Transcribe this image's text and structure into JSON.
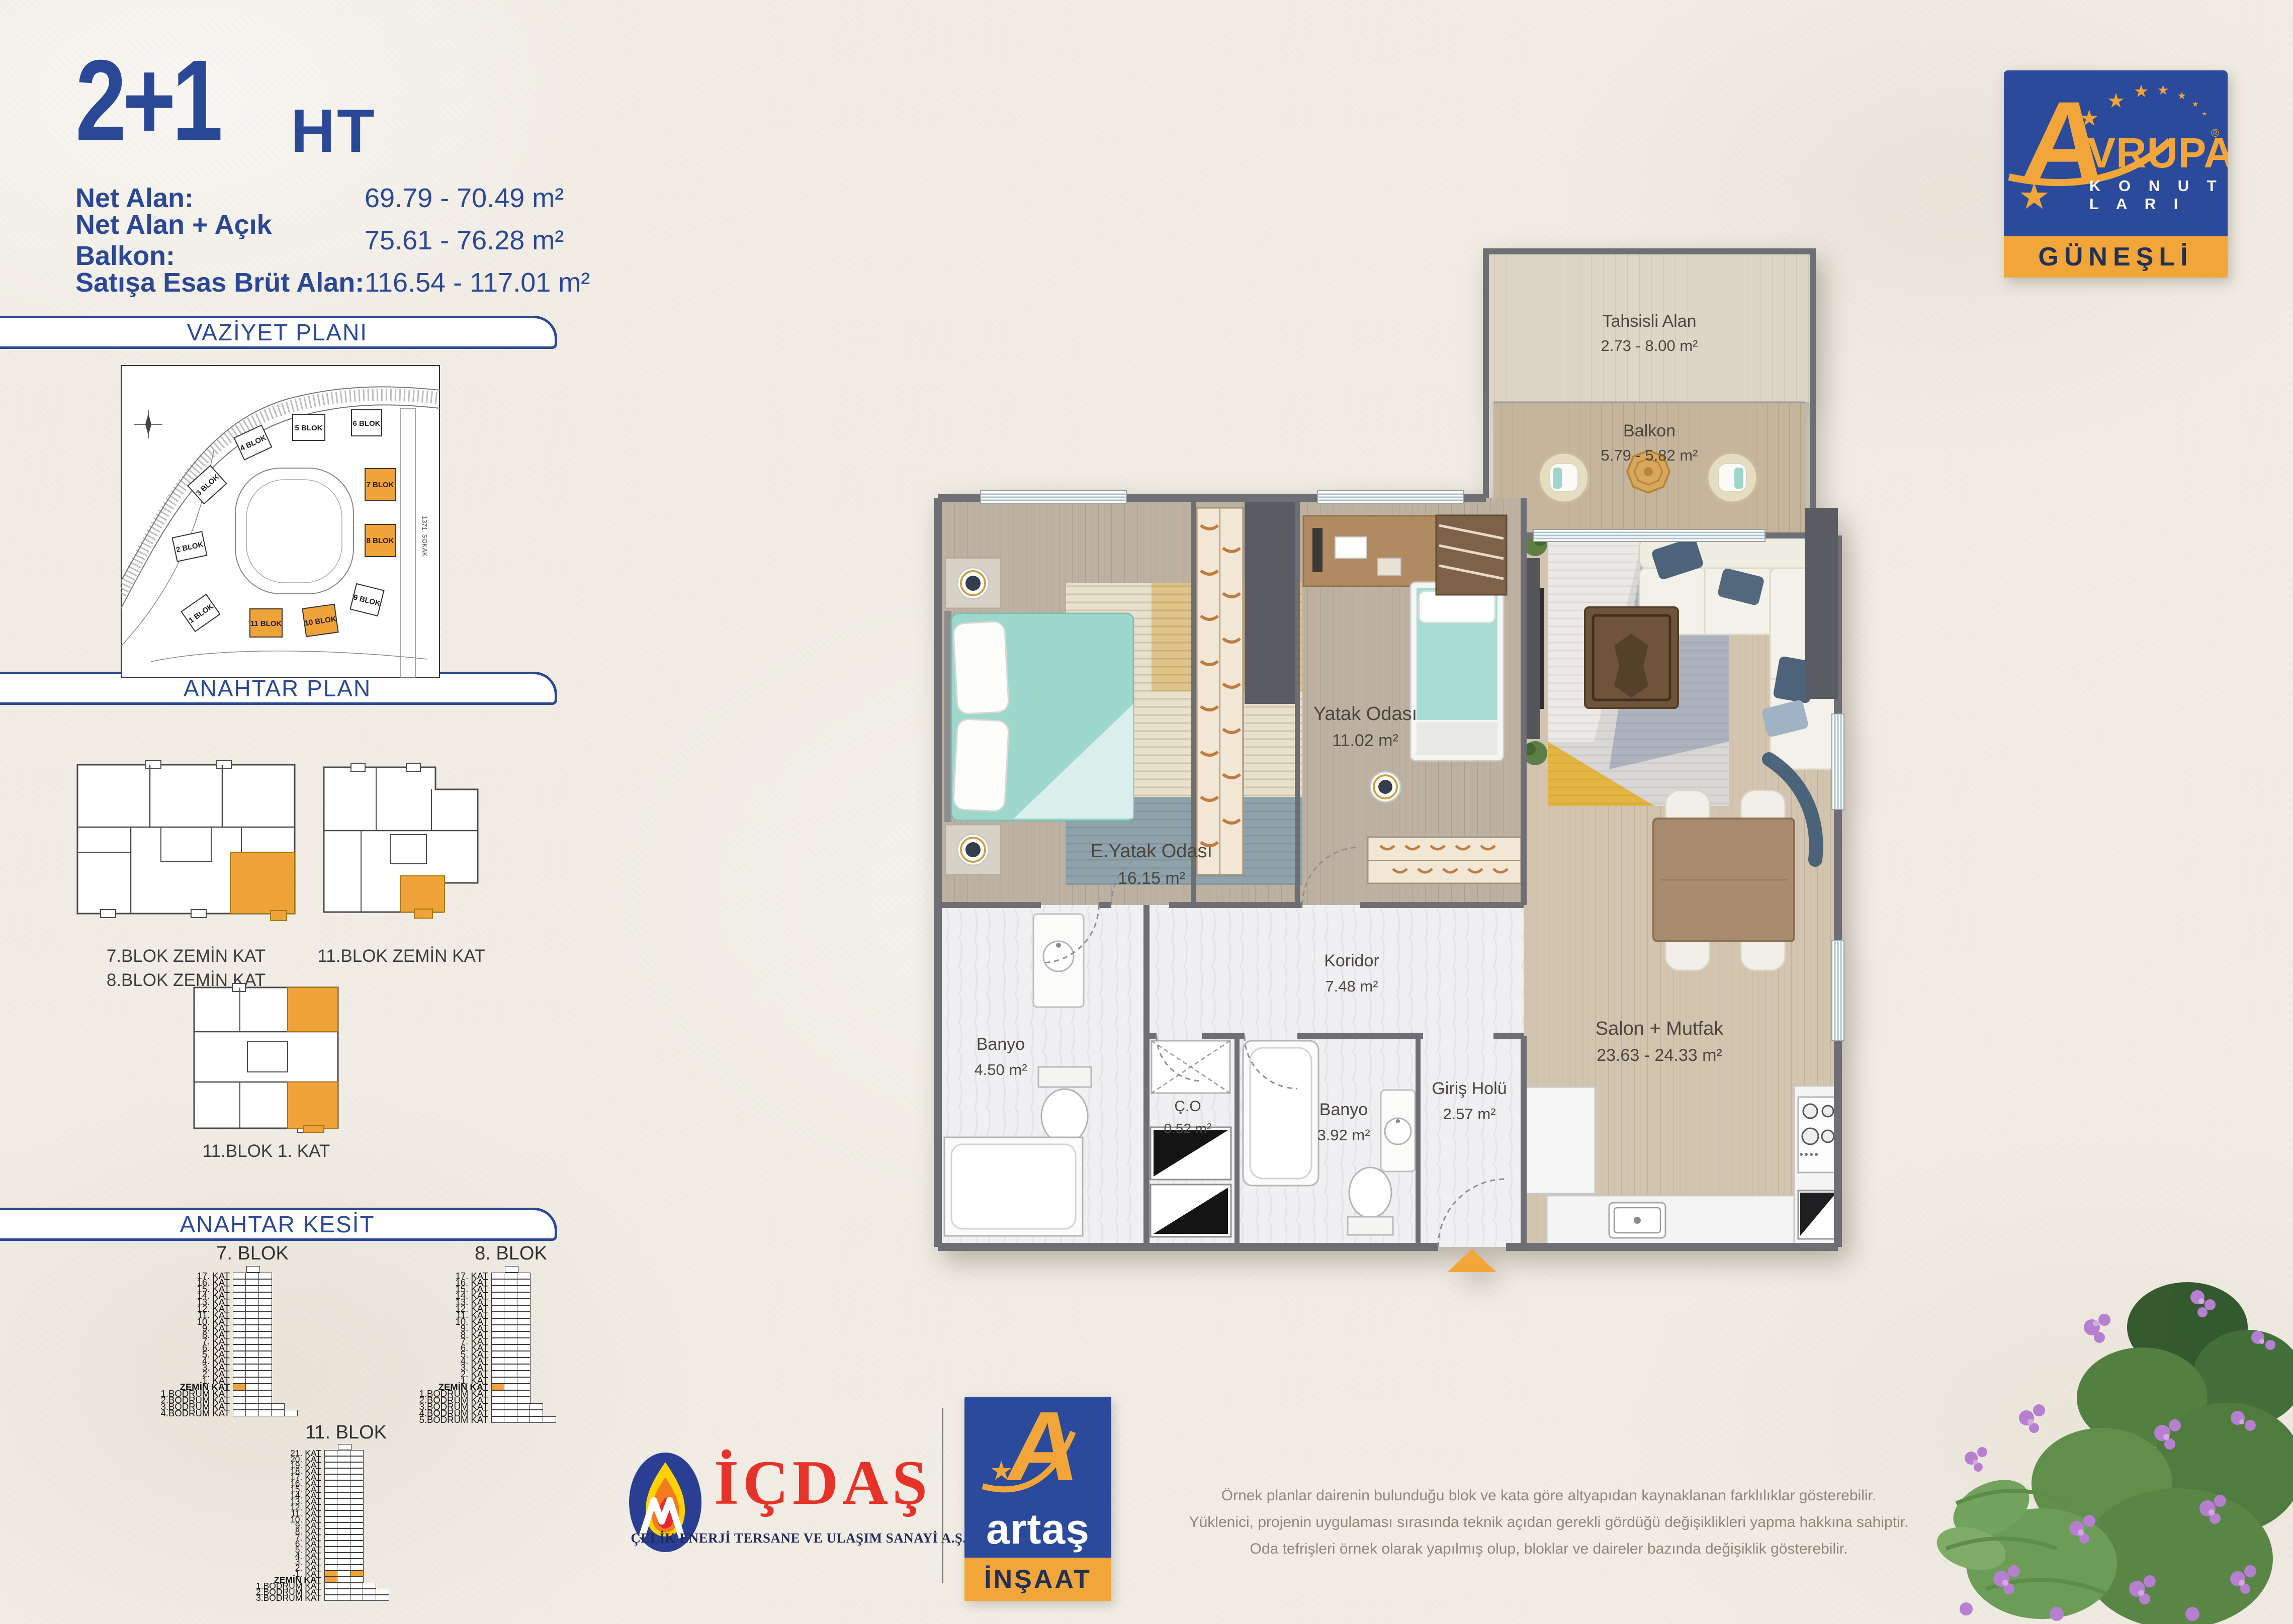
{
  "title": {
    "main": "2+1",
    "suffix": "HT"
  },
  "area_info": [
    {
      "label": "Net Alan:",
      "value": "69.79 - 70.49 m²"
    },
    {
      "label": "Net Alan + Açık Balkon:",
      "value": "75.61 - 76.28 m²"
    },
    {
      "label": "Satışa Esas Brüt Alan:",
      "value": "116.54 - 117.01 m²"
    }
  ],
  "sections": {
    "site_plan": "VAZİYET PLANI",
    "key_plan": "ANAHTAR PLAN",
    "key_section": "ANAHTAR KESİT"
  },
  "site_plan": {
    "street": "1371. SOKAK",
    "blocks": [
      {
        "label": "1 BLOK",
        "highlighted": false
      },
      {
        "label": "2 BLOK",
        "highlighted": false
      },
      {
        "label": "3 BLOK",
        "highlighted": false
      },
      {
        "label": "4 BLOK",
        "highlighted": false
      },
      {
        "label": "5 BLOK",
        "highlighted": false
      },
      {
        "label": "6 BLOK",
        "highlighted": false
      },
      {
        "label": "7 BLOK",
        "highlighted": true
      },
      {
        "label": "8 BLOK",
        "highlighted": true
      },
      {
        "label": "9 BLOK",
        "highlighted": false
      },
      {
        "label": "10 BLOK",
        "highlighted": true
      },
      {
        "label": "11 BLOK",
        "highlighted": true
      }
    ]
  },
  "key_plans": [
    {
      "caption": [
        "7.BLOK ZEMİN KAT",
        "8.BLOK ZEMİN KAT"
      ]
    },
    {
      "caption": [
        "11.BLOK ZEMİN KAT"
      ]
    },
    {
      "caption": [
        "11.BLOK 1. KAT"
      ]
    }
  ],
  "key_sections": {
    "towers": [
      {
        "name": "7. BLOK",
        "floors": [
          {
            "l": "",
            "c": 1,
            "roof": true
          },
          {
            "l": "17. KAT"
          },
          {
            "l": "16. KAT"
          },
          {
            "l": "15. KAT"
          },
          {
            "l": "14. KAT"
          },
          {
            "l": "13. KAT"
          },
          {
            "l": "12. KAT"
          },
          {
            "l": "11. KAT"
          },
          {
            "l": "10. KAT"
          },
          {
            "l": "9. KAT"
          },
          {
            "l": "8. KAT"
          },
          {
            "l": "7. KAT"
          },
          {
            "l": "6. KAT"
          },
          {
            "l": "5. KAT"
          },
          {
            "l": "4. KAT"
          },
          {
            "l": "3. KAT"
          },
          {
            "l": "2. KAT"
          },
          {
            "l": "1. KAT"
          },
          {
            "l": "ZEMİN KAT",
            "bold": true,
            "hl": [
              0
            ]
          },
          {
            "l": "1.BODRUM KAT"
          },
          {
            "l": "2.BODRUM KAT"
          },
          {
            "l": "3.BODRUM KAT",
            "c": 4
          },
          {
            "l": "4.BODRUM KAT",
            "c": 5
          }
        ]
      },
      {
        "name": "8. BLOK",
        "floors": [
          {
            "l": "",
            "c": 1,
            "roof": true
          },
          {
            "l": "17. KAT"
          },
          {
            "l": "16. KAT"
          },
          {
            "l": "15. KAT"
          },
          {
            "l": "14. KAT"
          },
          {
            "l": "13. KAT"
          },
          {
            "l": "12. KAT"
          },
          {
            "l": "11. KAT"
          },
          {
            "l": "10. KAT"
          },
          {
            "l": "9. KAT"
          },
          {
            "l": "8. KAT"
          },
          {
            "l": "7. KAT"
          },
          {
            "l": "6. KAT"
          },
          {
            "l": "5. KAT"
          },
          {
            "l": "4. KAT"
          },
          {
            "l": "3. KAT"
          },
          {
            "l": "2. KAT"
          },
          {
            "l": "1. KAT"
          },
          {
            "l": "ZEMİN KAT",
            "bold": true,
            "hl": [
              0
            ]
          },
          {
            "l": "1.BODRUM KAT"
          },
          {
            "l": "2.BODRUM KAT"
          },
          {
            "l": "3.BODRUM KAT",
            "c": 4
          },
          {
            "l": "4.BODRUM KAT",
            "c": 4
          },
          {
            "l": "5.BODRUM KAT",
            "c": 5
          }
        ]
      },
      {
        "name": "11. BLOK",
        "floors": [
          {
            "l": "",
            "c": 1,
            "roof": true
          },
          {
            "l": "21. KAT"
          },
          {
            "l": "20. KAT"
          },
          {
            "l": "19. KAT"
          },
          {
            "l": "18. KAT"
          },
          {
            "l": "17. KAT"
          },
          {
            "l": "16. KAT"
          },
          {
            "l": "15. KAT"
          },
          {
            "l": "14. KAT"
          },
          {
            "l": "13. KAT"
          },
          {
            "l": "12. KAT"
          },
          {
            "l": "11. KAT"
          },
          {
            "l": "10. KAT"
          },
          {
            "l": "9. KAT"
          },
          {
            "l": "8. KAT"
          },
          {
            "l": "7. KAT"
          },
          {
            "l": "6. KAT"
          },
          {
            "l": "5. KAT"
          },
          {
            "l": "4. KAT"
          },
          {
            "l": "3. KAT"
          },
          {
            "l": "2. KAT"
          },
          {
            "l": "1. KAT",
            "hl": [
              0,
              2
            ]
          },
          {
            "l": "ZEMİN KAT",
            "bold": true,
            "hl": [
              0
            ]
          },
          {
            "l": "1.BODRUM KAT",
            "c": 4
          },
          {
            "l": "2.BODRUM KAT",
            "c": 5
          },
          {
            "l": "3.BODRUM KAT",
            "c": 5
          }
        ]
      }
    ]
  },
  "floor_plan": {
    "rooms": {
      "tahsisli": {
        "name": "Tahsisli Alan",
        "area": "2.73 - 8.00 m²"
      },
      "balkon": {
        "name": "Balkon",
        "area": "5.79 - 5.82 m²"
      },
      "e_yatak": {
        "name": "E.Yatak Odası",
        "area": "16.15 m²"
      },
      "yatak": {
        "name": "Yatak Odası",
        "area": "11.02 m²"
      },
      "salon": {
        "name": "Salon + Mutfak",
        "area": "23.63 - 24.33 m²"
      },
      "koridor": {
        "name": "Koridor",
        "area": "7.48 m²"
      },
      "banyo1": {
        "name": "Banyo",
        "area": "4.50 m²"
      },
      "co": {
        "name": "Ç.O",
        "area": "0.52 m²"
      },
      "banyo2": {
        "name": "Banyo",
        "area": "3.92 m²"
      },
      "giris": {
        "name": "Giriş Holü",
        "area": "2.57 m²"
      }
    }
  },
  "logos": {
    "avrupa": {
      "a": "A",
      "rest": "VRUPA",
      "reg": "®",
      "konutlari": "K O N U T L A R I",
      "location": "GÜNEŞLİ",
      "star": "★"
    },
    "icdas": {
      "name": "İÇDAŞ",
      "subtitle": "ÇELİK ENERJİ TERSANE VE ULAŞIM SANAYİ A.Ş."
    },
    "artas": {
      "a": "A",
      "name": "artaş",
      "band": "İNŞAAT",
      "star": "★"
    }
  },
  "disclaimer": {
    "lines": [
      "Örnek planlar dairenin bulunduğu blok ve kata göre altyapıdan kaynaklanan farklılıklar gösterebilir.",
      "Yüklenici, projenin uygulaması sırasında teknik açıdan gerekli gördüğü değişiklikleri yapma hakkına sahiptir.",
      "Oda tefrişleri örnek olarak yapılmış olup, bloklar ve daireler bazında değişiklik gösterebilir."
    ]
  }
}
